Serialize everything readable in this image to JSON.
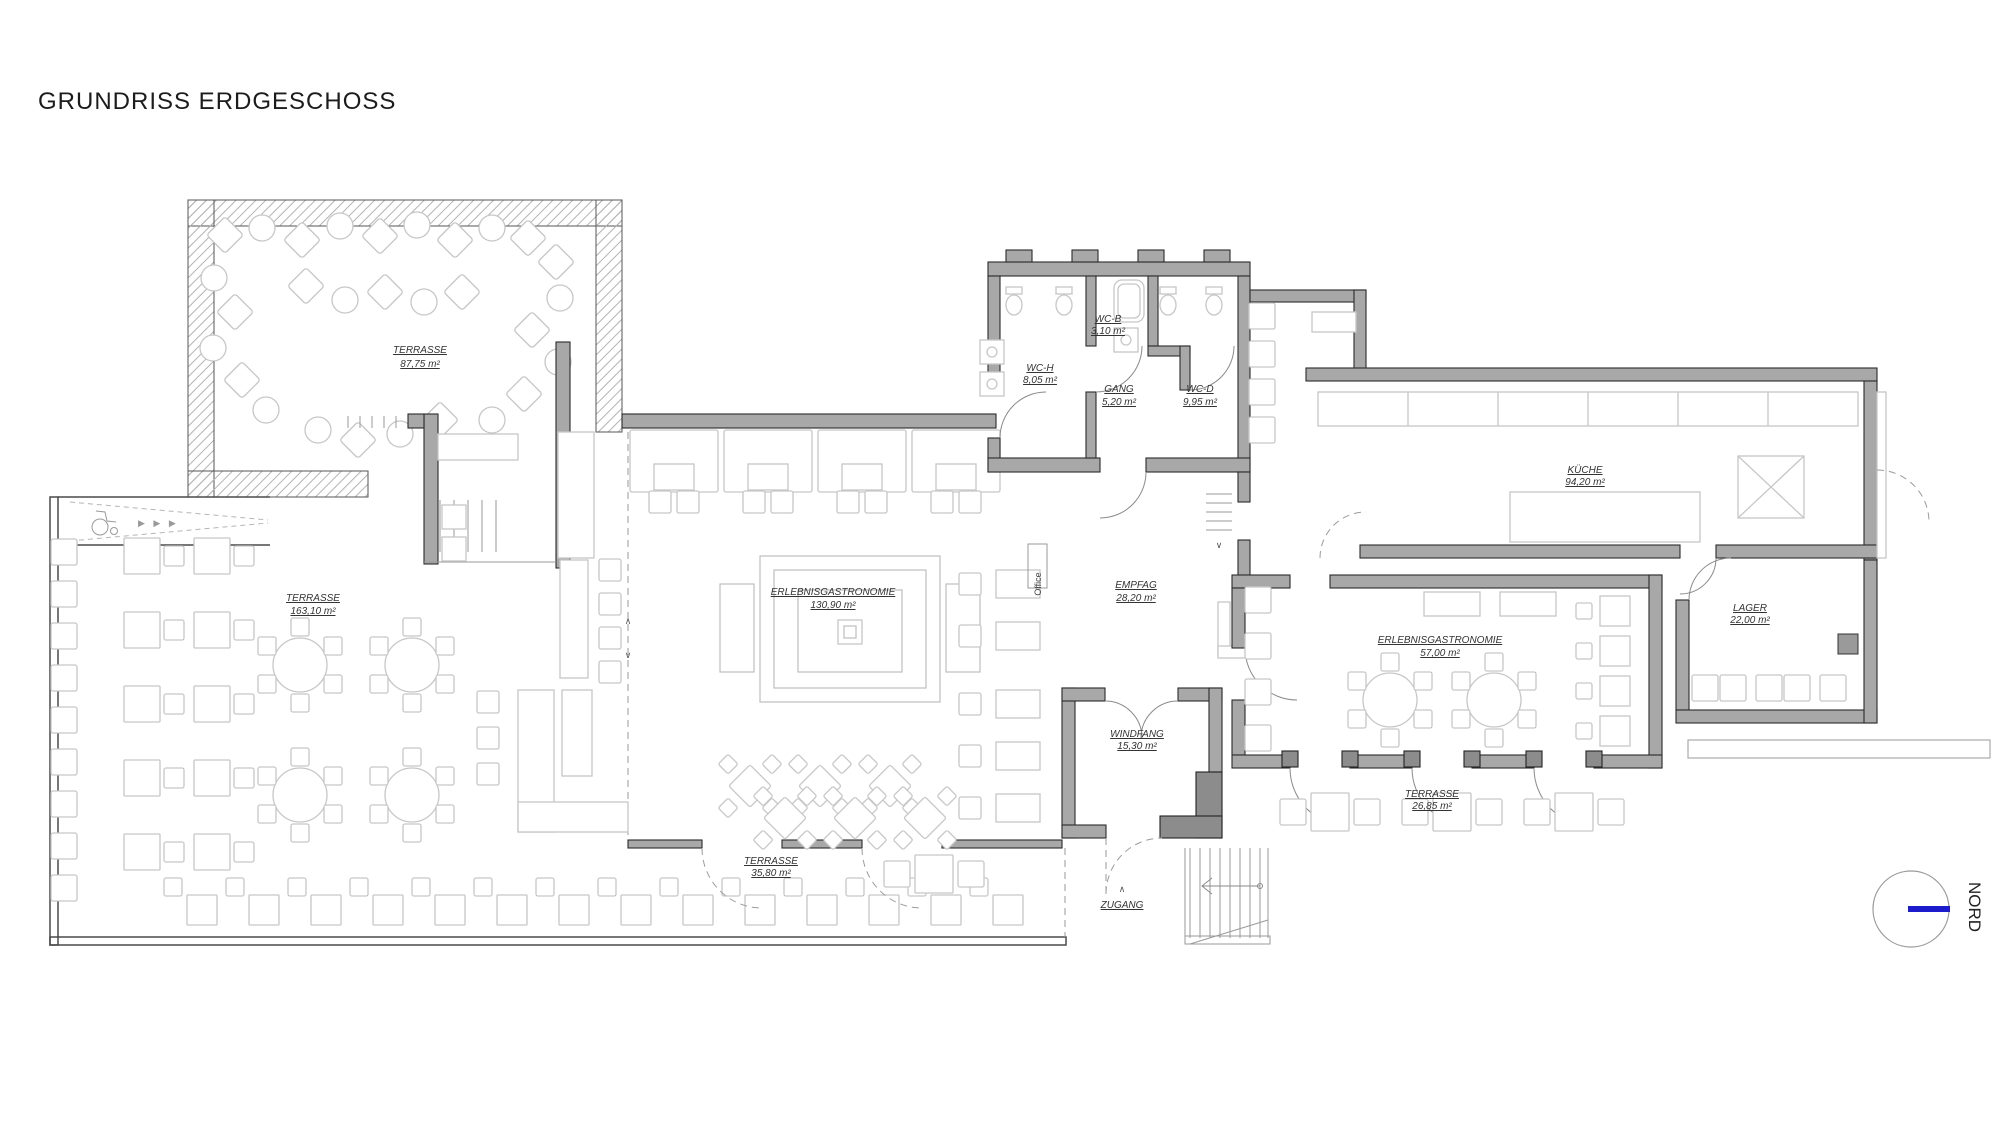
{
  "title": "GRUNDRISS ERDGESCHOSS",
  "rooms": [
    {
      "id": "terrasse-top",
      "name": "TERRASSE",
      "area": "87,75 m²"
    },
    {
      "id": "terrasse-left",
      "name": "TERRASSE",
      "area": "163,10 m²"
    },
    {
      "id": "erlebnis-main",
      "name": "ERLEBNISGASTRONOMIE",
      "area": "130,90 m²"
    },
    {
      "id": "empfang",
      "name": "EMPFAG",
      "area": "28,20 m²"
    },
    {
      "id": "wc-b",
      "name": "WC-B",
      "area": "3,10 m²"
    },
    {
      "id": "wc-h",
      "name": "WC-H",
      "area": "8,05 m²"
    },
    {
      "id": "gang",
      "name": "GANG",
      "area": "5,20 m²"
    },
    {
      "id": "wc-d",
      "name": "WC-D",
      "area": "9,95 m²"
    },
    {
      "id": "kueche",
      "name": "KÜCHE",
      "area": "94,20 m²"
    },
    {
      "id": "erlebnis-right",
      "name": "ERLEBNISGASTRONOMIE",
      "area": "57,00 m²"
    },
    {
      "id": "lager",
      "name": "LAGER",
      "area": "22,00 m²"
    },
    {
      "id": "windfang",
      "name": "WINDFANG",
      "area": "15,30 m²"
    },
    {
      "id": "terrasse-right",
      "name": "TERRASSE",
      "area": "26,85 m²"
    },
    {
      "id": "terrasse-bottom",
      "name": "TERRASSE",
      "area": "35,80 m²"
    }
  ],
  "annotations": {
    "office": "Office",
    "zugang": "ZUGANG",
    "nord": "NORD",
    "ramp_arrows": "▶ ▶ ▶",
    "caret_up": "∧",
    "caret_down": "∨"
  },
  "colors": {
    "wall": "#a8a8a8",
    "wall_outline": "#2b2b2b",
    "furniture_stroke": "#c7c7c7",
    "north_arrow": "#1c1ccd"
  }
}
